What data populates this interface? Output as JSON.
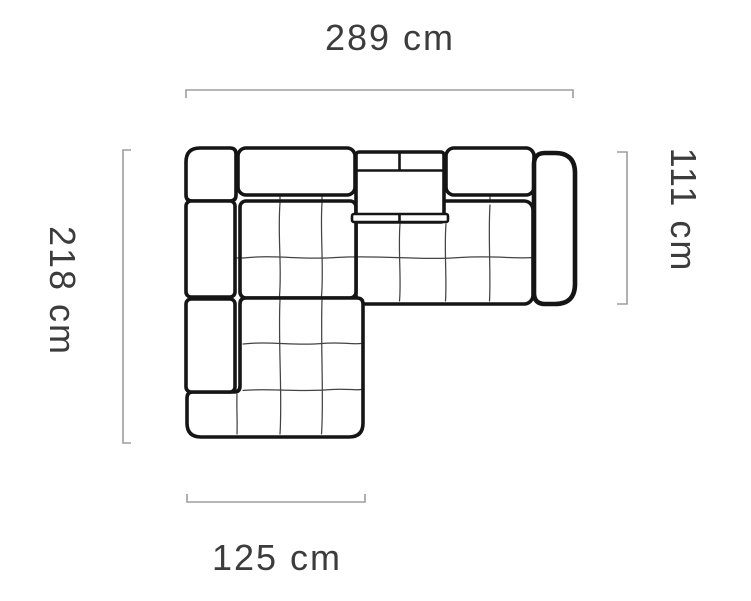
{
  "diagram": {
    "kind": "furniture-dimension-drawing",
    "subject": "corner-sofa-top-view",
    "unit": "cm",
    "dimension_labels": {
      "top": "289 cm",
      "left": "218 cm",
      "right": "111 cm",
      "bottom": "125 cm"
    },
    "dimension_values": {
      "total_width_cm": 289,
      "total_depth_cm": 218,
      "right_side_depth_cm": 111,
      "chaise_width_cm": 125
    },
    "colors": {
      "sofa_outline": "#151515",
      "dimension_line": "#9d9d9d",
      "label_text": "#3c3c3c",
      "background": "#ffffff"
    }
  }
}
